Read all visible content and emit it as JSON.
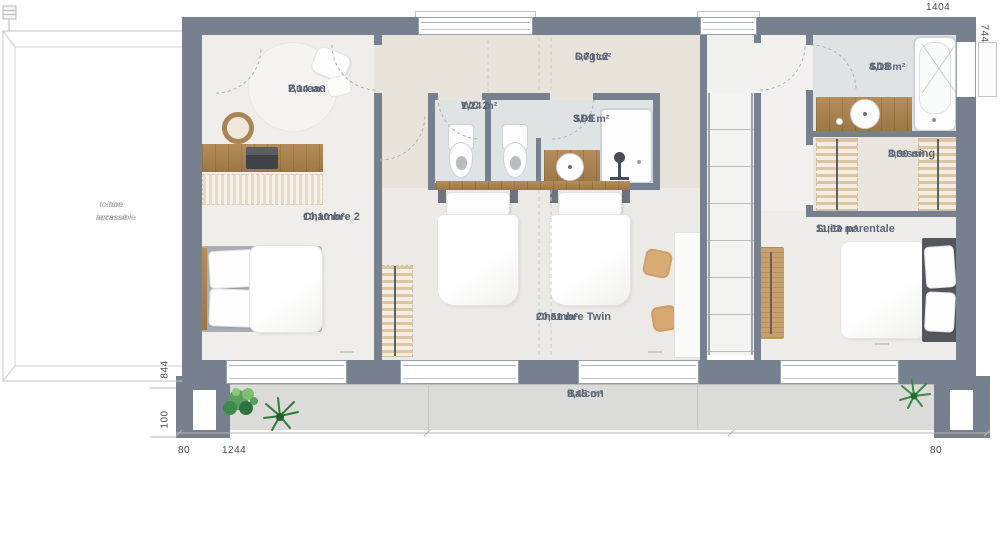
{
  "plan": {
    "rooms": {
      "bureau": {
        "name": "Bureau",
        "area": "7,14 m²"
      },
      "chambre2": {
        "name": "Chambre 2",
        "area": "10,10 m²"
      },
      "wc2": {
        "name": "WC 2",
        "area": "1,24 m²"
      },
      "sde": {
        "name": "SDE",
        "area": "3,93 m²"
      },
      "degt2": {
        "name": "Dégt.2",
        "area": "6,71 m²"
      },
      "sdb": {
        "name": "SDB",
        "area": "4,13 m²"
      },
      "dressing": {
        "name": "Dressing",
        "area": "3,30 m²"
      },
      "suite": {
        "name": "Suite parentale",
        "area": "11,63 m²"
      },
      "twin": {
        "name": "Chambre Twin",
        "area": "20,51 m²"
      },
      "balcon": {
        "name": "Balcon",
        "area": "9,45 m²"
      }
    },
    "dimensions": {
      "top": "1404",
      "right": "744",
      "left_upper": "844",
      "left_lower": "100",
      "bottom_left": "80",
      "bottom_center": "1244",
      "bottom_right": "80"
    },
    "terrace_note_line1": "toiture terrasse",
    "terrace_note_line2": "non accessible",
    "colors": {
      "wall": "#76808e",
      "floor": "#eeedea",
      "hall": "#e8e3db",
      "bath": "#dfe3e4",
      "dressing": "#ebe5df",
      "balcony": "#dbdbd9",
      "wood": "#ad8757",
      "label": "#5c6677",
      "dim": "#4a4a4a"
    }
  }
}
